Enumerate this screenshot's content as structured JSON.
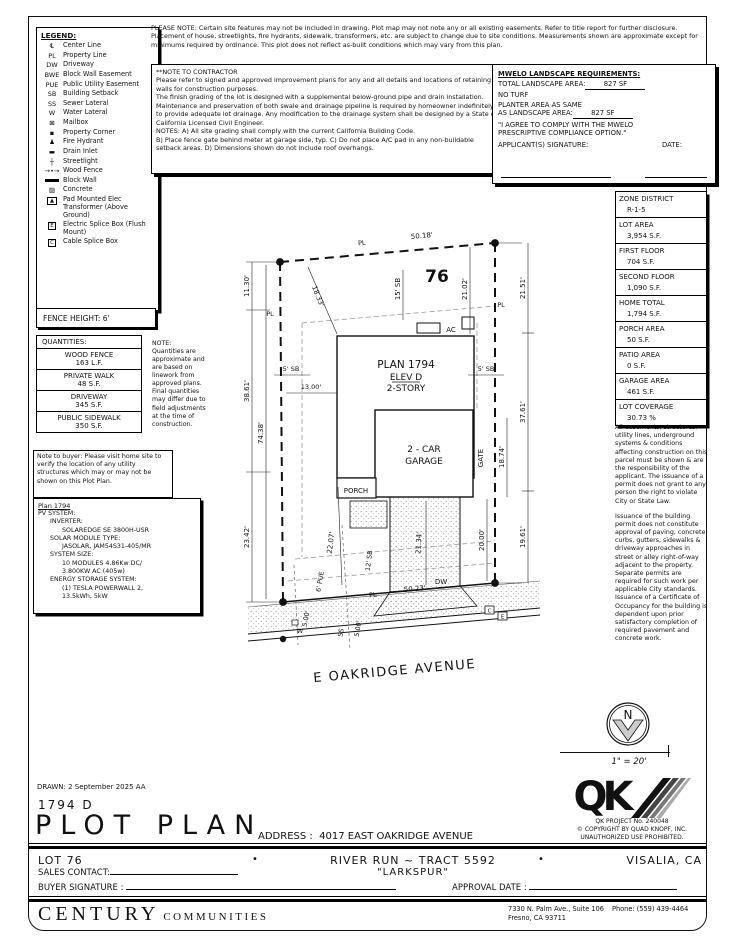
{
  "notes": {
    "please_note": "PLEASE NOTE:  Certain site features may not be included in drawing.  Plot map may not note any or all existing easements. Refer to title report for further disclosure.  Placement of house, streetlights, fire hydrants, sidewalk, transformers, etc. are subject to change due to site conditions.  Measurements shown are approximate except for minimums required by ordinance.  This plot does not reflect as-built conditions which may vary from this plan.",
    "contractor_title": "**NOTE TO CONTRACTOR",
    "contractor_p1": "Please refer to signed and approved improvement plans for any and all details and locations of retaining walls for construction purposes.",
    "contractor_p2": "The finish grading of the lot is designed with a supplemental below-ground pipe and drain installation.  Maintenance and preservation of both swale and drainage pipeline is required by homeowner indefinitely to provide adequate lot drainage.  Any modification to the drainage system shall be designed by a State of California Licensed Civil Engineer.",
    "contractor_p3": "NOTES:  A) All site grading shall comply with the current California Building Code.",
    "contractor_p4": "B) Place fence gate behind meter at garage side, typ.  C) Do not place A/C pad in any non-buildable setback areas.  D) Dimensions shown do not include roof overhangs."
  },
  "mwelo": {
    "title": "MWELO LANDSCAPE REQUIREMENTS:",
    "total_label": "TOTAL LANDSCAPE AREA:",
    "total_value": "827 SF",
    "no_turf": "NO TURF",
    "planter_label1": "PLANTER AREA AS SAME",
    "planter_label2": "AS LANDSCAPE AREA:",
    "planter_value": "827 SF",
    "agree1": "\"I AGREE TO COMPLY WITH THE MWELO",
    "agree2": "PRESCRIPTIVE COMPLIANCE OPTION.\"",
    "applicant": "APPLICANT(S) SIGNATURE:",
    "date": "DATE:"
  },
  "legend": {
    "title": "LEGEND:",
    "items": [
      {
        "sym": "℄",
        "label": "Center Line"
      },
      {
        "sym": "PL",
        "label": "Property Line"
      },
      {
        "sym": "DW",
        "label": "Driveway"
      },
      {
        "sym": "BWE",
        "label": "Block Wall Easement"
      },
      {
        "sym": "PUE",
        "label": "Public Utility Easement"
      },
      {
        "sym": "SB",
        "label": "Building Setback"
      },
      {
        "sym": "SS",
        "label": "Sewer Lateral"
      },
      {
        "sym": "W",
        "label": "Water Lateral"
      },
      {
        "sym": "⊠",
        "label": "Mailbox"
      },
      {
        "sym": "▪",
        "label": "Property Corner"
      },
      {
        "sym": "♟",
        "label": "Fire Hydrant"
      },
      {
        "sym": "▬",
        "label": "Drain Inlet"
      },
      {
        "sym": "┼",
        "label": "Streetlight"
      },
      {
        "sym": "→•→",
        "label": "Wood Fence"
      },
      {
        "sym": "",
        "label": "Block Wall"
      },
      {
        "sym": "▨",
        "label": "Concrete"
      },
      {
        "sym": "▲",
        "label": "Pad Mounted Elec Transformer (Above Ground)"
      },
      {
        "sym": "E",
        "label": "Electric Splice Box (Flush Mount)"
      },
      {
        "sym": "C",
        "label": "Cable Splice Box"
      }
    ]
  },
  "fence_height": "FENCE HEIGHT: 6'",
  "quantities": {
    "title": "QUANTITIES:",
    "rows": [
      {
        "name": "WOOD FENCE",
        "value": "163 L.F."
      },
      {
        "name": "PRIVATE WALK",
        "value": "48 S.F."
      },
      {
        "name": "DRIVEWAY",
        "value": "345 S.F."
      },
      {
        "name": "PUBLIC SIDEWALK",
        "value": "350 S.F."
      }
    ],
    "note": "NOTE:\nQuantities are approximate and are based on linework from approved plans.  Final quantities may differ due to field adjustments at the time of construction."
  },
  "buyer_note": "Note to buyer: Please visit home site to verify the location of any utility structures which may or may not be shown on this Plot Plan.",
  "pv": {
    "title": "Plan 1794",
    "lines": [
      "PV SYSTEM:",
      "      INVERTER:",
      "            SOLAREDGE SE 3800H-USR",
      "      SOLAR MODULE TYPE:",
      "            JASOLAR, JAM54S31-405/MR",
      "      SYSTEM SIZE:",
      "            10 MODULES 4.86Kw DC/",
      "            3.800KW AC (405w)",
      "      ENERGY STORAGE SYSTEM:",
      "            (1) TESLA POWERWALL 2,",
      "            13.5kWh, 5kW"
    ]
  },
  "zone": {
    "rows": [
      {
        "label": "ZONE DISTRICT",
        "value": "R-1-5"
      },
      {
        "label": "LOT AREA",
        "value": "3,954 S.F."
      },
      {
        "label": "FIRST FLOOR",
        "value": "704 S.F."
      },
      {
        "label": "SECOND FLOOR",
        "value": "1,090 S.F."
      },
      {
        "label": "HOME TOTAL",
        "value": "1,794 S.F."
      },
      {
        "label": "PORCH AREA",
        "value": "50 S.F."
      },
      {
        "label": "PATIO AREA",
        "value": "0 S.F."
      },
      {
        "label": "GARAGE AREA",
        "value": "461 S.F."
      },
      {
        "label": "LOT COVERAGE",
        "value": "30.73 %"
      }
    ]
  },
  "easements": {
    "p1": "All easements, structures, utility lines, underground systems & conditions affecting construction on this parcel must be shown & are the responsibility of the applicant. The issuance of a permit does not grant to any person the right to violate City or State Law.",
    "p2": "Issuance of the building permit does not constitute approval of paving, concrete curbs, gutters, sidewalks & driveway approaches in street or alley right-of-way adjacent to the property. Separate permits are required for such work per applicable City standards. Issuance of a Certificate of Occupancy for the building is dependent upon prior satisfactory completion of required pavement and concrete work."
  },
  "compass": {
    "n": "N",
    "scale": "1\" = 20'"
  },
  "qk": {
    "logo": "QK",
    "project": "QK PROJECT No. 240048",
    "copyright": "©  COPYRIGHT BY QUAD KNOPF, INC.",
    "unauthorized": "UNAUTHORIZED USE PROHIBITED."
  },
  "titleblock": {
    "drawn": "DRAWN:   2 September 2025   AA",
    "plan_code": "1794   D",
    "title": "PLOT PLAN",
    "address_label": "ADDRESS :",
    "address": "4017 EAST OAKRIDGE AVENUE"
  },
  "footer": {
    "lot": "LOT 76",
    "bullet": "•",
    "tract": "RIVER RUN ~ TRACT 5592",
    "community": "\"LARKSPUR\"",
    "city": "VISALIA, CA",
    "sales_contact": "SALES CONTACT:",
    "buyer_signature": "BUYER SIGNATURE :",
    "approval_date": "APPROVAL DATE :",
    "brand_main": "CENTURY",
    "brand_sub": "COMMUNITIES",
    "address_line1": "7330 N. Palm Ave., Suite 106",
    "phone": "Phone:  (559) 439-4464",
    "address_line2": "Fresno, CA  93711"
  },
  "plot": {
    "lot_number": "76",
    "plan": "PLAN 1794",
    "elev": "ELEV D",
    "story": "2-STORY",
    "garage1": "2 - CAR",
    "garage2": "GARAGE",
    "porch": "PORCH",
    "ac": "AC",
    "gate": "GATE",
    "dw": "DW",
    "street": "E OAKRIDGE AVENUE",
    "pl": "PL",
    "splice_c": "C",
    "splice_e": "E",
    "dims": {
      "rear_pl": "50.18'",
      "front_pl": "50.23'",
      "left_top": "11.30'",
      "left_mid": "38.61'",
      "left_bot": "23.42'",
      "left_inner": "74.38'",
      "right_top": "21.51'",
      "right_mid": "37.61'",
      "right_bot": "19.61'",
      "inner_right_top": "21.02'",
      "inner_right_mid": "18.74'",
      "inner_right_bot": "20.00'",
      "diag_left": "18.33'",
      "rear_sb": "15' SB",
      "side_sb": "5' SB",
      "front_offset": "13.00'",
      "walk_dim": "22.07'",
      "front_sb": "12' SB",
      "drive_len": "21.34'",
      "pue": "6' PUE",
      "lat_a": "5.00'",
      "lat_b": "5.00'",
      "ss": "SS",
      "w": "W"
    }
  }
}
